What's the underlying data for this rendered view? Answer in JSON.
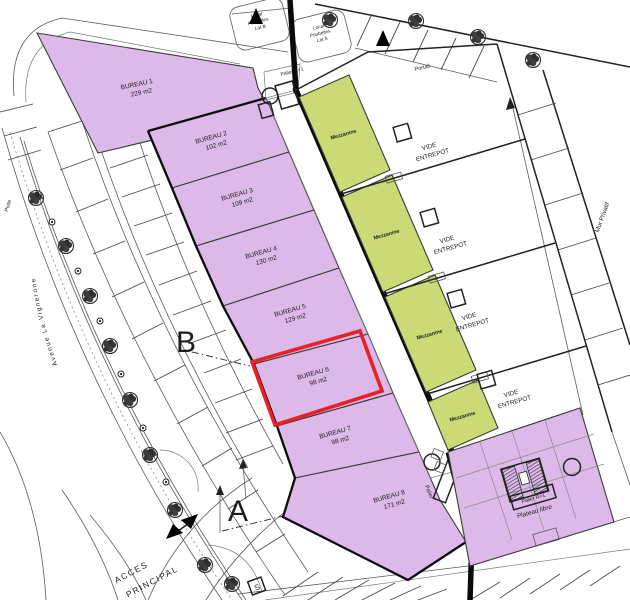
{
  "labels": {
    "bureaus": [
      {
        "name": "BUREAU 1",
        "area": "229 m2"
      },
      {
        "name": "BUREAU 2",
        "area": "102 m2"
      },
      {
        "name": "BUREAU 3",
        "area": "109 m2"
      },
      {
        "name": "BUREAU 4",
        "area": "130 m2"
      },
      {
        "name": "BUREAU 5",
        "area": "129 m2"
      },
      {
        "name": "BUREAU 6",
        "area": "98 m2"
      },
      {
        "name": "BUREAU 7",
        "area": "98 m2"
      },
      {
        "name": "BUREAU 8",
        "area": "171 m2"
      }
    ],
    "mezzanine": "Mezzanine",
    "vide_line1": "VIDE",
    "vide_line2": "ENTREPOT",
    "plateau": "Plateau libre",
    "palier": "Palier",
    "palier_r1": "Palier R+1",
    "local_b": [
      "Local",
      "Poubelles",
      "Lot B"
    ],
    "local_a": [
      "Local",
      "Poubelles",
      "Lot A"
    ],
    "portail": "Portail",
    "mur_privatif": "Mur Privatif",
    "avenue": "Avenue  La  Vignerone",
    "piste": "Piste",
    "acces_line1": "ACCES",
    "acces_line2": "PRINCIPAL",
    "zone_a": "A",
    "zone_b": "B",
    "sign_s": "S"
  },
  "highlight": {
    "unit": "BUREAU 6",
    "color": "#e82127"
  },
  "colors": {
    "bureau_fill": "#dcb9e9",
    "mezzanine_fill": "#cbda74",
    "corridor_fill": "#f5f08c",
    "wall": "#0a0a0a"
  }
}
